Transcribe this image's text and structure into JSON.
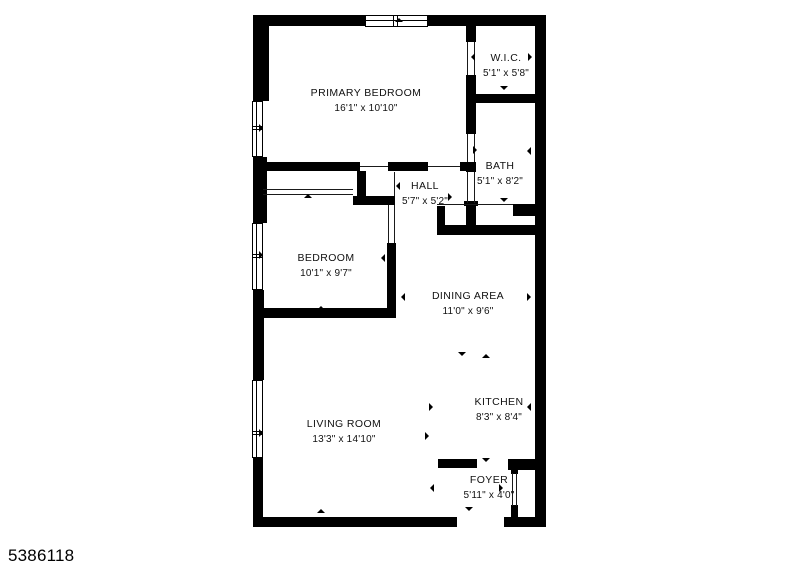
{
  "photo_id": "5386118",
  "colors": {
    "wall": "#000000",
    "text": "#111111",
    "background": "#ffffff"
  },
  "rooms": [
    {
      "id": "primary-bedroom",
      "name": "PRIMARY BEDROOM",
      "dims": "16'1\" x 10'10\"",
      "cx": 366,
      "cy": 101
    },
    {
      "id": "wic",
      "name": "W.I.C.",
      "dims": "5'1\" x 5'8\"",
      "cx": 506,
      "cy": 66
    },
    {
      "id": "bath",
      "name": "BATH",
      "dims": "5'1\" x 8'2\"",
      "cx": 500,
      "cy": 174
    },
    {
      "id": "hall",
      "name": "HALL",
      "dims": "5'7\" x 5'2\"",
      "cx": 425,
      "cy": 194
    },
    {
      "id": "bedroom",
      "name": "BEDROOM",
      "dims": "10'1\" x 9'7\"",
      "cx": 326,
      "cy": 266
    },
    {
      "id": "dining-area",
      "name": "DINING AREA",
      "dims": "11'0\" x 9'6\"",
      "cx": 468,
      "cy": 304
    },
    {
      "id": "living-room",
      "name": "LIVING ROOM",
      "dims": "13'3\" x 14'10\"",
      "cx": 344,
      "cy": 432
    },
    {
      "id": "kitchen",
      "name": "KITCHEN",
      "dims": "8'3\" x 8'4\"",
      "cx": 499,
      "cy": 410
    },
    {
      "id": "foyer",
      "name": "FOYER",
      "dims": "5'11\" x 4'0\"",
      "cx": 489,
      "cy": 488
    }
  ],
  "walls": [
    {
      "x": 253,
      "y": 15,
      "w": 293,
      "h": 11
    },
    {
      "x": 253,
      "y": 15,
      "w": 16,
      "h": 86
    },
    {
      "x": 253,
      "y": 157,
      "w": 14,
      "h": 66
    },
    {
      "x": 253,
      "y": 290,
      "w": 11,
      "h": 90
    },
    {
      "x": 253,
      "y": 458,
      "w": 10,
      "h": 69
    },
    {
      "x": 535,
      "y": 15,
      "w": 11,
      "h": 512
    },
    {
      "x": 253,
      "y": 517,
      "w": 204,
      "h": 10
    },
    {
      "x": 504,
      "y": 517,
      "w": 42,
      "h": 10
    },
    {
      "x": 253,
      "y": 162,
      "w": 107,
      "h": 9
    },
    {
      "x": 388,
      "y": 162,
      "w": 40,
      "h": 9
    },
    {
      "x": 460,
      "y": 162,
      "w": 16,
      "h": 9
    },
    {
      "x": 357,
      "y": 171,
      "w": 9,
      "h": 26
    },
    {
      "x": 353,
      "y": 196,
      "w": 42,
      "h": 9
    },
    {
      "x": 255,
      "y": 186,
      "w": 8,
      "h": 10
    },
    {
      "x": 466,
      "y": 26,
      "w": 10,
      "h": 16
    },
    {
      "x": 466,
      "y": 75,
      "w": 10,
      "h": 28
    },
    {
      "x": 466,
      "y": 94,
      "w": 80,
      "h": 9
    },
    {
      "x": 466,
      "y": 103,
      "w": 10,
      "h": 31
    },
    {
      "x": 466,
      "y": 162,
      "w": 10,
      "h": 10
    },
    {
      "x": 464,
      "y": 201,
      "w": 14,
      "h": 5
    },
    {
      "x": 466,
      "y": 203,
      "w": 10,
      "h": 30
    },
    {
      "x": 437,
      "y": 206,
      "w": 8,
      "h": 23
    },
    {
      "x": 437,
      "y": 225,
      "w": 109,
      "h": 10
    },
    {
      "x": 513,
      "y": 204,
      "w": 33,
      "h": 12
    },
    {
      "x": 387,
      "y": 243,
      "w": 9,
      "h": 74
    },
    {
      "x": 253,
      "y": 308,
      "w": 143,
      "h": 10
    },
    {
      "x": 438,
      "y": 459,
      "w": 39,
      "h": 9
    },
    {
      "x": 508,
      "y": 459,
      "w": 38,
      "h": 11
    },
    {
      "x": 511,
      "y": 470,
      "w": 7,
      "h": 4
    },
    {
      "x": 511,
      "y": 505,
      "w": 7,
      "h": 12
    }
  ],
  "windows": [
    {
      "x": 252,
      "y": 101,
      "w": 11,
      "h": 56,
      "divider": "h",
      "d1": 126,
      "d2": 129
    },
    {
      "x": 252,
      "y": 223,
      "w": 11,
      "h": 67,
      "divider": "h",
      "d1": 254,
      "d2": 257
    },
    {
      "x": 252,
      "y": 380,
      "w": 11,
      "h": 78,
      "divider": "h",
      "d1": 431,
      "d2": 434
    },
    {
      "x": 365,
      "y": 15,
      "w": 63,
      "h": 12,
      "divider": "v",
      "d1": 393,
      "d2": 397,
      "midline": 20
    }
  ],
  "thin_lines": [
    {
      "x": 467,
      "y": 42,
      "w": 1,
      "h": 33
    },
    {
      "x": 474,
      "y": 42,
      "w": 1,
      "h": 33
    },
    {
      "x": 428,
      "y": 166,
      "w": 32,
      "h": 1
    },
    {
      "x": 360,
      "y": 166,
      "w": 28,
      "h": 1
    },
    {
      "x": 388,
      "y": 205,
      "w": 1,
      "h": 38
    },
    {
      "x": 394,
      "y": 205,
      "w": 1,
      "h": 38
    },
    {
      "x": 394,
      "y": 172,
      "w": 1,
      "h": 24
    },
    {
      "x": 467,
      "y": 134,
      "w": 1,
      "h": 28
    },
    {
      "x": 474,
      "y": 134,
      "w": 1,
      "h": 28
    },
    {
      "x": 467,
      "y": 172,
      "w": 1,
      "h": 31
    },
    {
      "x": 474,
      "y": 172,
      "w": 1,
      "h": 31
    },
    {
      "x": 437,
      "y": 204,
      "w": 76,
      "h": 1
    },
    {
      "x": 263,
      "y": 189,
      "w": 90,
      "h": 1
    },
    {
      "x": 263,
      "y": 194,
      "w": 90,
      "h": 1
    },
    {
      "x": 512,
      "y": 473,
      "w": 1,
      "h": 33
    },
    {
      "x": 516,
      "y": 473,
      "w": 1,
      "h": 33
    }
  ],
  "ticks": [
    {
      "x": 399,
      "y": 22,
      "dir": "up"
    },
    {
      "x": 263,
      "y": 128,
      "dir": "right"
    },
    {
      "x": 475,
      "y": 57,
      "dir": "left"
    },
    {
      "x": 532,
      "y": 57,
      "dir": "right"
    },
    {
      "x": 504,
      "y": 90,
      "dir": "down"
    },
    {
      "x": 477,
      "y": 150,
      "dir": "right"
    },
    {
      "x": 531,
      "y": 151,
      "dir": "left"
    },
    {
      "x": 504,
      "y": 202,
      "dir": "down"
    },
    {
      "x": 400,
      "y": 186,
      "dir": "left"
    },
    {
      "x": 452,
      "y": 197,
      "dir": "right"
    },
    {
      "x": 308,
      "y": 198,
      "dir": "up"
    },
    {
      "x": 263,
      "y": 255,
      "dir": "right"
    },
    {
      "x": 385,
      "y": 258,
      "dir": "left"
    },
    {
      "x": 321,
      "y": 310,
      "dir": "up"
    },
    {
      "x": 405,
      "y": 297,
      "dir": "left"
    },
    {
      "x": 531,
      "y": 297,
      "dir": "right"
    },
    {
      "x": 462,
      "y": 356,
      "dir": "down"
    },
    {
      "x": 486,
      "y": 358,
      "dir": "up"
    },
    {
      "x": 433,
      "y": 407,
      "dir": "right"
    },
    {
      "x": 531,
      "y": 407,
      "dir": "left"
    },
    {
      "x": 429,
      "y": 436,
      "dir": "right"
    },
    {
      "x": 263,
      "y": 433,
      "dir": "right"
    },
    {
      "x": 321,
      "y": 513,
      "dir": "up"
    },
    {
      "x": 486,
      "y": 462,
      "dir": "down"
    },
    {
      "x": 434,
      "y": 488,
      "dir": "left"
    },
    {
      "x": 503,
      "y": 488,
      "dir": "right"
    },
    {
      "x": 469,
      "y": 511,
      "dir": "down"
    }
  ]
}
